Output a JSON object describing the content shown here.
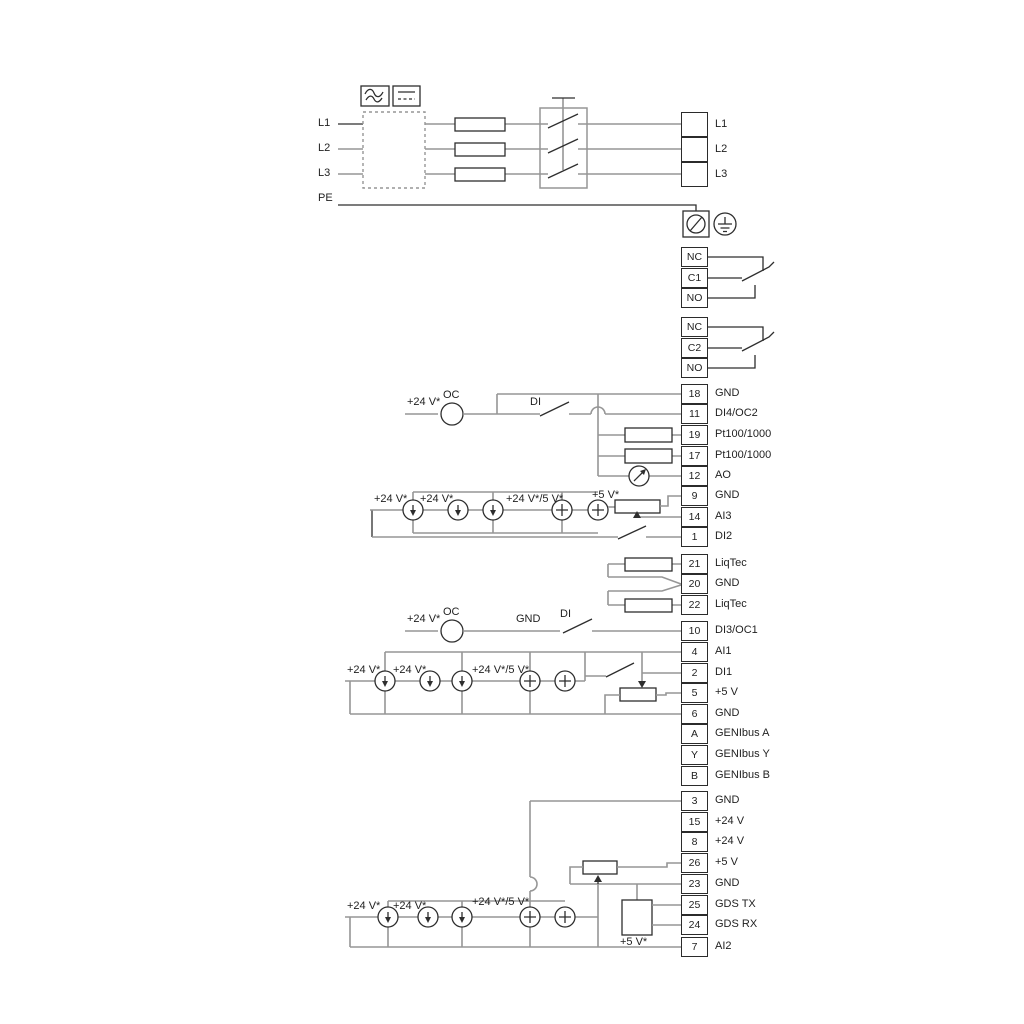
{
  "power": {
    "in": [
      "L1",
      "L2",
      "L3",
      "PE"
    ],
    "out": [
      "L1",
      "L2",
      "L3"
    ]
  },
  "relays": {
    "r1": [
      "NC",
      "C1",
      "NO"
    ],
    "r2": [
      "NC",
      "C2",
      "NO"
    ]
  },
  "terminals": {
    "g1": [
      {
        "n": "18",
        "label": "GND"
      },
      {
        "n": "11",
        "label": "DI4/OC2"
      },
      {
        "n": "19",
        "label": "Pt100/1000"
      },
      {
        "n": "17",
        "label": "Pt100/1000"
      },
      {
        "n": "12",
        "label": "AO"
      },
      {
        "n": "9",
        "label": "GND"
      },
      {
        "n": "14",
        "label": "AI3"
      },
      {
        "n": "1",
        "label": "DI2"
      }
    ],
    "g2": [
      {
        "n": "21",
        "label": "LiqTec"
      },
      {
        "n": "20",
        "label": "GND"
      },
      {
        "n": "22",
        "label": "LiqTec"
      }
    ],
    "g3": [
      {
        "n": "10",
        "label": "DI3/OC1"
      }
    ],
    "g4": [
      {
        "n": "4",
        "label": "AI1"
      },
      {
        "n": "2",
        "label": "DI1"
      },
      {
        "n": "5",
        "label": "+5 V"
      },
      {
        "n": "6",
        "label": "GND"
      }
    ],
    "g5": [
      {
        "n": "A",
        "label": "GENIbus A"
      },
      {
        "n": "Y",
        "label": "GENIbus Y"
      },
      {
        "n": "B",
        "label": "GENIbus B"
      }
    ],
    "g6": [
      {
        "n": "3",
        "label": "GND"
      },
      {
        "n": "15",
        "label": "+24 V"
      },
      {
        "n": "8",
        "label": "+24 V"
      },
      {
        "n": "26",
        "label": "+5 V"
      },
      {
        "n": "23",
        "label": "GND"
      },
      {
        "n": "25",
        "label": "GDS TX"
      },
      {
        "n": "24",
        "label": "GDS RX"
      },
      {
        "n": "7",
        "label": "AI2"
      }
    ]
  },
  "annotations": {
    "di4": {
      "v24": "+24 V*",
      "oc": "OC",
      "di": "DI"
    },
    "ai3": {
      "v24a": "+24 V*",
      "v24b": "+24 V*",
      "v24_5": "+24 V*/5 V*",
      "v5": "+5 V*"
    },
    "di3": {
      "v24": "+24 V*",
      "oc": "OC",
      "gnd": "GND",
      "di": "DI"
    },
    "ai1": {
      "v24a": "+24 V*",
      "v24b": "+24 V*",
      "v24_5": "+24 V*/5 V*"
    },
    "ai2": {
      "v24a": "+24 V*",
      "v24b": "+24 V*",
      "v24_5": "+24 V*/5 V*",
      "v5": "+5 V*"
    }
  },
  "colors": {
    "wire_gray": "#969696",
    "line_black": "#2e2e2e",
    "background": "#ffffff"
  }
}
